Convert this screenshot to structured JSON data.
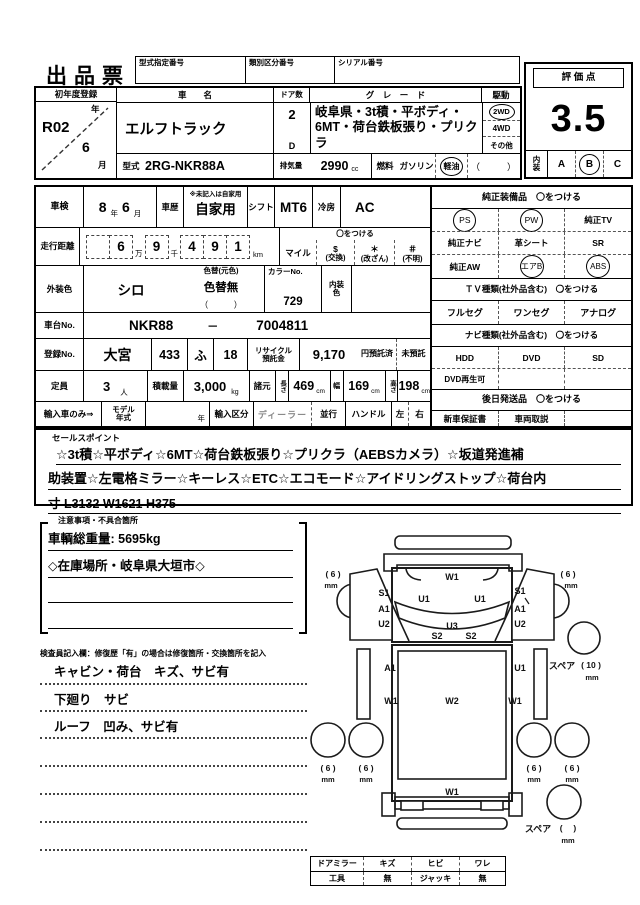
{
  "title": "出品票",
  "top_labels": {
    "model_designation": "型式指定番号",
    "class_division": "類別区分番号",
    "serial": "シリアル番号"
  },
  "score_box": {
    "label": "評 価 点",
    "score": "3.5",
    "interior_label1": "内",
    "interior_label2": "装",
    "options": [
      "A",
      "B",
      "C"
    ],
    "selected": "B"
  },
  "registration": {
    "label": "初年度登録",
    "year": "R02",
    "year_unit": "年",
    "month": "6",
    "month_unit": "月"
  },
  "vehicle": {
    "name_label": "車　　名",
    "name": "エルフトラック",
    "doors_label": "ドア数",
    "doors": "2",
    "doors_sub": "D",
    "grade_label": "グ　レ　ー　ド",
    "grade": "岐阜県・3t積・平ボディ・6MT・荷台鉄板張り・プリクラ",
    "drive_label": "駆動",
    "drive_opts": [
      "2WD",
      "4WD",
      "その他"
    ],
    "drive_selected": "2WD",
    "model_label": "型式",
    "model": "2RG-NKR88A",
    "disp_label": "排気量",
    "disp": "2990",
    "disp_unit": "cc",
    "fuel_label": "燃料",
    "fuel_opts": [
      "ガソリン",
      "軽油"
    ],
    "fuel_other": "（　　　）",
    "fuel_selected": "軽油"
  },
  "inspection_row": {
    "shaken_label": "車検",
    "year": "8",
    "year_unit": "年",
    "month": "6",
    "month_unit": "月",
    "history_label": "車歴",
    "history_note": "※未記入は自家用",
    "history": "自家用",
    "shift_label": "シフト",
    "shift": "MT6",
    "cooling_label": "冷房",
    "cooling": "AC"
  },
  "mileage": {
    "label": "走行距離",
    "d_man10": "",
    "d_man": "6",
    "unit_man": "万",
    "d_sen": "9",
    "unit_sen": "千",
    "d1": "4",
    "d2": "9",
    "d3": "1",
    "unit_km": "km",
    "circle_note": "〇をつける",
    "mile": "マイル",
    "marks": [
      {
        "sym": "$",
        "label": "(交換)"
      },
      {
        "sym": "＊",
        "label": "(改ざん)"
      },
      {
        "sym": "＃",
        "label": "(不明)"
      }
    ]
  },
  "color_row": {
    "label": "外装色",
    "color": "シロ",
    "change_label": "色替(元色)",
    "change": "色替無",
    "change_paren": "（　　　）",
    "color_no_label": "カラーNo.",
    "color_no": "729",
    "interior_label1": "内装",
    "interior_label2": "色"
  },
  "chassis": {
    "label": "車台No.",
    "prefix": "NKR88",
    "dash": "－",
    "number": "7004811"
  },
  "reg_no": {
    "label": "登録No.",
    "office": "大宮",
    "class_no": "433",
    "kana": "ふ",
    "number": "18",
    "recycle_label1": "リサイクル",
    "recycle_label2": "預託金",
    "recycle_fee": "9,170",
    "deposited": "円預託済",
    "not_deposited": "未預託"
  },
  "capacity": {
    "label": "定員",
    "value": "3",
    "unit": "人",
    "load_label": "積載量",
    "load": "3,000",
    "load_unit": "kg",
    "spec_label": "諸元",
    "length_label": "長さ",
    "length": "469",
    "length_unit": "cm",
    "width_label": "幅",
    "width": "169",
    "width_unit": "cm",
    "height_label": "高さ",
    "height": "198",
    "height_unit": "cm"
  },
  "import_row": {
    "label": "輸入車のみ⇒",
    "my_label1": "モデル",
    "my_label2": "年式",
    "year_unit": "年",
    "division_label": "輸入区分",
    "dealer": "ディーラー",
    "parallel": "並行",
    "handle_label": "ハンドル",
    "left": "左",
    "right": "右"
  },
  "equipment": {
    "header": "純正装備品　〇をつける",
    "items": [
      {
        "label": "PS"
      },
      {
        "label": "PW"
      },
      {
        "label": "純正TV"
      },
      {
        "label": "純正ナビ"
      },
      {
        "label": "革シート"
      },
      {
        "label": "SR"
      },
      {
        "label": "純正AW"
      },
      {
        "label": "エアB"
      },
      {
        "label": "ABS"
      }
    ],
    "circled": [
      "PS",
      "PW",
      "エアB",
      "ABS"
    ],
    "tv_header": "ＴＶ種類(社外品含む)　〇をつける",
    "tv_options": [
      "フルセグ",
      "ワンセグ",
      "アナログ"
    ],
    "navi_header": "ナビ種類(社外品含む)　〇をつける",
    "navi_options": [
      "HDD",
      "DVD",
      "SD"
    ],
    "dvd_playable": "DVD再生可",
    "later_header": "後日発送品　〇をつける",
    "later_options": [
      "新車保証書",
      "車両取説"
    ]
  },
  "sales_points": {
    "label": "セールスポイント",
    "line1": "☆3t積☆平ボディ☆6MT☆荷台鉄板張り☆プリクラ（AEBSカメラ）☆坂道発進補",
    "line2": "助装置☆左電格ミラー☆キーレス☆ETC☆エコモード☆アイドリングストップ☆荷台内",
    "line3": "寸 L3132 W1621 H375"
  },
  "notes": {
    "header": "注意事項・不具合箇所",
    "line1": "車輌総重量: 5695kg",
    "line2": "◇在庫場所・岐阜県大垣市◇"
  },
  "inspector": {
    "header": "検査員記入欄：修復歴「有」の場合は修復箇所・交換箇所を記入",
    "line1": "キャビン・荷台　キズ、サビ有",
    "line2": "下廻り　サビ",
    "line3": "ルーフ　凹み、サビ有"
  },
  "diagram": {
    "codes": {
      "w1": "W1",
      "u1l": "U1",
      "u1r": "U1",
      "u3": "U3",
      "s2l": "S2",
      "s2r": "S2",
      "s1l": "S1",
      "a1l": "A1",
      "u2l": "U2",
      "s1r": "S1",
      "a1r": "A1",
      "u2r": "U2",
      "bed_a1": "A1",
      "bed_u1": "U1",
      "bed_w1l": "W1",
      "bed_w2": "W2",
      "bed_w1r": "W1",
      "bed_w1b": "W1"
    },
    "tires": {
      "fl": "( 6 )",
      "fr": "( 6 )",
      "rl1": "( 6 )",
      "rl2": "( 6 )",
      "rr1": "( 6 )",
      "rr2": "( 6 )",
      "mm": "mm",
      "spare_label": "スペア",
      "spare1_val": "( 10 )",
      "spare2_val": "(　 )"
    }
  },
  "bottom_table": {
    "r1": [
      "ドアミラー",
      "キズ",
      "ヒビ",
      "ワレ"
    ],
    "r2": [
      "工具",
      "無",
      "ジャッキ",
      "無"
    ]
  }
}
